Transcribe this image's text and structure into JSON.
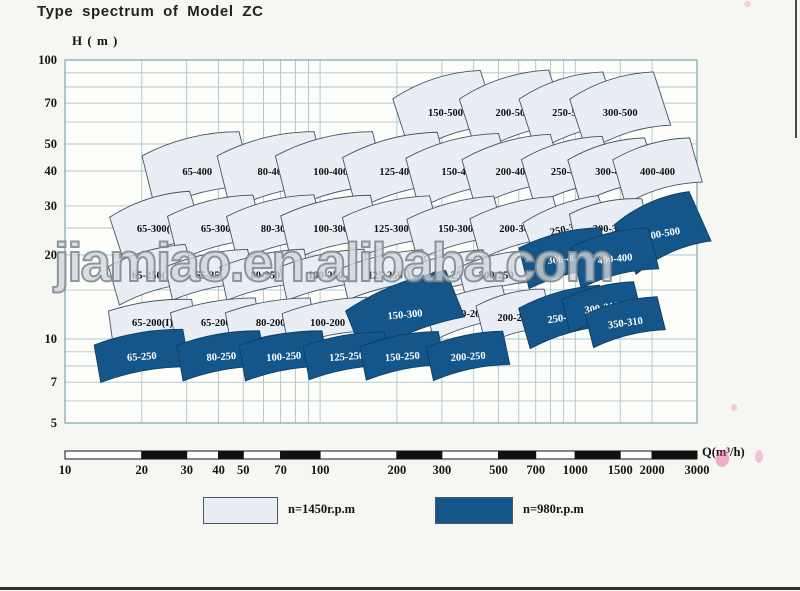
{
  "title": "Type spectrum of Model ZC",
  "watermark": "jiamiao.en.alibaba.com",
  "axis": {
    "y_label": "H ( m )",
    "x_label": "Q(m³/h)",
    "y_ticks": [
      100,
      70,
      50,
      40,
      30,
      20,
      10,
      7,
      5
    ],
    "x_ticks": [
      10,
      20,
      30,
      40,
      50,
      70,
      100,
      200,
      300,
      500,
      700,
      1000,
      1500,
      2000,
      3000
    ]
  },
  "legend": [
    {
      "label": "n=1450r.p.m",
      "rpm": 1450,
      "tone": "light"
    },
    {
      "label": "n=980r.p.m",
      "rpm": 980,
      "tone": "dark"
    }
  ],
  "colors": {
    "light": "#e9eef4",
    "dark": "#15568a",
    "dark_stroke": "#0d3e63",
    "patch_border": "#44546a",
    "grid": "#a9c6ce",
    "frame": "#7fa3ad",
    "tick_text": "#141414",
    "ruler_black": "#111111",
    "ruler_white": "#ffffff"
  },
  "chart_data": {
    "type": "area",
    "title": "Type spectrum of Model ZC",
    "xlabel": "Q (m³/h)",
    "ylabel": "H (m)",
    "x_scale": "log",
    "y_scale": "log",
    "xlim": [
      10,
      3000
    ],
    "ylim": [
      5,
      100
    ],
    "grid": true,
    "legend_position": "bottom",
    "x_gridlines": [
      10,
      20,
      30,
      40,
      50,
      60,
      70,
      80,
      90,
      100,
      200,
      300,
      400,
      500,
      600,
      700,
      800,
      900,
      1000,
      1500,
      2000,
      3000
    ],
    "y_gridlines": [
      5,
      6,
      7,
      8,
      9,
      10,
      15,
      20,
      25,
      30,
      40,
      50,
      60,
      70,
      80,
      90,
      100
    ],
    "regions": [
      {
        "model": "150-500",
        "rpm": 1450,
        "q": 310,
        "h": 65,
        "w": 92,
        "ht": 58,
        "rot": -18
      },
      {
        "model": "200-500",
        "rpm": 1450,
        "q": 570,
        "h": 65,
        "w": 94,
        "ht": 58,
        "rot": -18
      },
      {
        "model": "250-500",
        "rpm": 1450,
        "q": 950,
        "h": 65,
        "w": 88,
        "ht": 56,
        "rot": -18
      },
      {
        "model": "300-500",
        "rpm": 1450,
        "q": 1500,
        "h": 65,
        "w": 88,
        "ht": 56,
        "rot": -18
      },
      {
        "model": "65-400",
        "rpm": 1450,
        "q": 33,
        "h": 40,
        "w": 100,
        "ht": 56,
        "rot": -14
      },
      {
        "model": "80-400",
        "rpm": 1450,
        "q": 65,
        "h": 40,
        "w": 100,
        "ht": 56,
        "rot": -14
      },
      {
        "model": "100-400",
        "rpm": 1450,
        "q": 110,
        "h": 40,
        "w": 100,
        "ht": 56,
        "rot": -14
      },
      {
        "model": "125-400",
        "rpm": 1450,
        "q": 200,
        "h": 40,
        "w": 98,
        "ht": 54,
        "rot": -15
      },
      {
        "model": "150-400",
        "rpm": 1450,
        "q": 350,
        "h": 40,
        "w": 96,
        "ht": 52,
        "rot": -15
      },
      {
        "model": "200-400",
        "rpm": 1450,
        "q": 570,
        "h": 40,
        "w": 92,
        "ht": 50,
        "rot": -16
      },
      {
        "model": "250-400",
        "rpm": 1450,
        "q": 940,
        "h": 40,
        "w": 84,
        "ht": 48,
        "rot": -16
      },
      {
        "model": "300-400",
        "rpm": 1450,
        "q": 1400,
        "h": 40,
        "w": 80,
        "ht": 46,
        "rot": -16
      },
      {
        "model": "400-400",
        "rpm": 1450,
        "q": 2100,
        "h": 40,
        "w": 80,
        "ht": 46,
        "rot": -16
      },
      {
        "model": "65-300(I)",
        "rpm": 1450,
        "q": 23,
        "h": 25,
        "w": 84,
        "ht": 50,
        "rot": -18
      },
      {
        "model": "65-300",
        "rpm": 1450,
        "q": 39,
        "h": 25,
        "w": 88,
        "ht": 46,
        "rot": -14
      },
      {
        "model": "80-300",
        "rpm": 1450,
        "q": 67,
        "h": 25,
        "w": 90,
        "ht": 46,
        "rot": -14
      },
      {
        "model": "100-300",
        "rpm": 1450,
        "q": 110,
        "h": 25,
        "w": 92,
        "ht": 46,
        "rot": -13
      },
      {
        "model": "125-300",
        "rpm": 1450,
        "q": 190,
        "h": 25,
        "w": 90,
        "ht": 44,
        "rot": -14
      },
      {
        "model": "150-300",
        "rpm": 1450,
        "q": 340,
        "h": 25,
        "w": 90,
        "ht": 42,
        "rot": -15
      },
      {
        "model": "200-300",
        "rpm": 1450,
        "q": 590,
        "h": 25,
        "w": 86,
        "ht": 42,
        "rot": -15
      },
      {
        "model": "250-300",
        "rpm": 1450,
        "q": 930,
        "h": 25,
        "w": 80,
        "ht": 40,
        "rot": -20,
        "lrot": -12
      },
      {
        "model": "300-300",
        "rpm": 1450,
        "q": 1370,
        "h": 25,
        "w": 74,
        "ht": 44,
        "rot": -12
      },
      {
        "model": "65-250(I)",
        "rpm": 1450,
        "q": 22,
        "h": 17,
        "w": 80,
        "ht": 40,
        "rot": -16
      },
      {
        "model": "65-250",
        "rpm": 1450,
        "q": 37,
        "h": 17,
        "w": 84,
        "ht": 34,
        "rot": -12
      },
      {
        "model": "80-250",
        "rpm": 1450,
        "q": 61,
        "h": 17,
        "w": 86,
        "ht": 34,
        "rot": -12
      },
      {
        "model": "100-250",
        "rpm": 1450,
        "q": 105,
        "h": 17,
        "w": 86,
        "ht": 34,
        "rot": -12
      },
      {
        "model": "125-250",
        "rpm": 1450,
        "q": 180,
        "h": 17,
        "w": 84,
        "ht": 32,
        "rot": -13
      },
      {
        "model": "150-250",
        "rpm": 1450,
        "q": 320,
        "h": 17,
        "w": 78,
        "ht": 32,
        "rot": -14
      },
      {
        "model": "200-250",
        "rpm": 1450,
        "q": 490,
        "h": 17,
        "w": 70,
        "ht": 32,
        "rot": -14
      },
      {
        "model": "65-200(I)",
        "rpm": 1450,
        "q": 22,
        "h": 11.5,
        "w": 84,
        "ht": 34,
        "rot": -8
      },
      {
        "model": "65-200",
        "rpm": 1450,
        "q": 39,
        "h": 11.5,
        "w": 86,
        "ht": 34,
        "rot": -10
      },
      {
        "model": "80-200",
        "rpm": 1450,
        "q": 64,
        "h": 11.5,
        "w": 86,
        "ht": 34,
        "rot": -10
      },
      {
        "model": "100-200",
        "rpm": 1450,
        "q": 107,
        "h": 11.5,
        "w": 86,
        "ht": 34,
        "rot": -11
      },
      {
        "model": "150-200",
        "rpm": 1450,
        "q": 380,
        "h": 12.4,
        "w": 80,
        "ht": 34,
        "rot": -16
      },
      {
        "model": "200-200",
        "rpm": 1450,
        "q": 580,
        "h": 12,
        "w": 70,
        "ht": 40,
        "rot": -14
      },
      {
        "model": "400-500",
        "rpm": 980,
        "q": 2200,
        "h": 24,
        "w": 82,
        "ht": 54,
        "rot": -24,
        "lrot": -10
      },
      {
        "model": "300-400",
        "rpm": 980,
        "q": 910,
        "h": 19.5,
        "w": 84,
        "ht": 42,
        "rot": -14,
        "lrot": -6
      },
      {
        "model": "400-400",
        "rpm": 980,
        "q": 1430,
        "h": 19.5,
        "w": 80,
        "ht": 42,
        "rot": -14,
        "lrot": -6
      },
      {
        "model": "150-300",
        "rpm": 980,
        "q": 215,
        "h": 12.3,
        "w": 108,
        "ht": 50,
        "rot": -22,
        "lrot": -5
      },
      {
        "model": "250-310",
        "rpm": 980,
        "q": 910,
        "h": 12,
        "w": 84,
        "ht": 42,
        "rot": -16,
        "lrot": -8
      },
      {
        "model": "300-310",
        "rpm": 980,
        "q": 1270,
        "h": 13,
        "w": 74,
        "ht": 34,
        "rot": -14,
        "lrot": -8
      },
      {
        "model": "350-310",
        "rpm": 980,
        "q": 1570,
        "h": 11.5,
        "w": 74,
        "ht": 34,
        "rot": -14,
        "lrot": -8
      },
      {
        "model": "65-250",
        "rpm": 980,
        "q": 20,
        "h": 8.7,
        "w": 90,
        "ht": 38,
        "rot": -10,
        "lrot": -4
      },
      {
        "model": "80-250",
        "rpm": 980,
        "q": 41,
        "h": 8.7,
        "w": 84,
        "ht": 36,
        "rot": -10,
        "lrot": -4
      },
      {
        "model": "100-250",
        "rpm": 980,
        "q": 72,
        "h": 8.7,
        "w": 84,
        "ht": 36,
        "rot": -10,
        "lrot": -4
      },
      {
        "model": "125-250",
        "rpm": 980,
        "q": 127,
        "h": 8.7,
        "w": 82,
        "ht": 34,
        "rot": -10,
        "lrot": -4
      },
      {
        "model": "150-250",
        "rpm": 980,
        "q": 210,
        "h": 8.7,
        "w": 80,
        "ht": 34,
        "rot": -11,
        "lrot": -4
      },
      {
        "model": "200-250",
        "rpm": 980,
        "q": 380,
        "h": 8.7,
        "w": 78,
        "ht": 34,
        "rot": -12,
        "lrot": -4
      }
    ]
  }
}
